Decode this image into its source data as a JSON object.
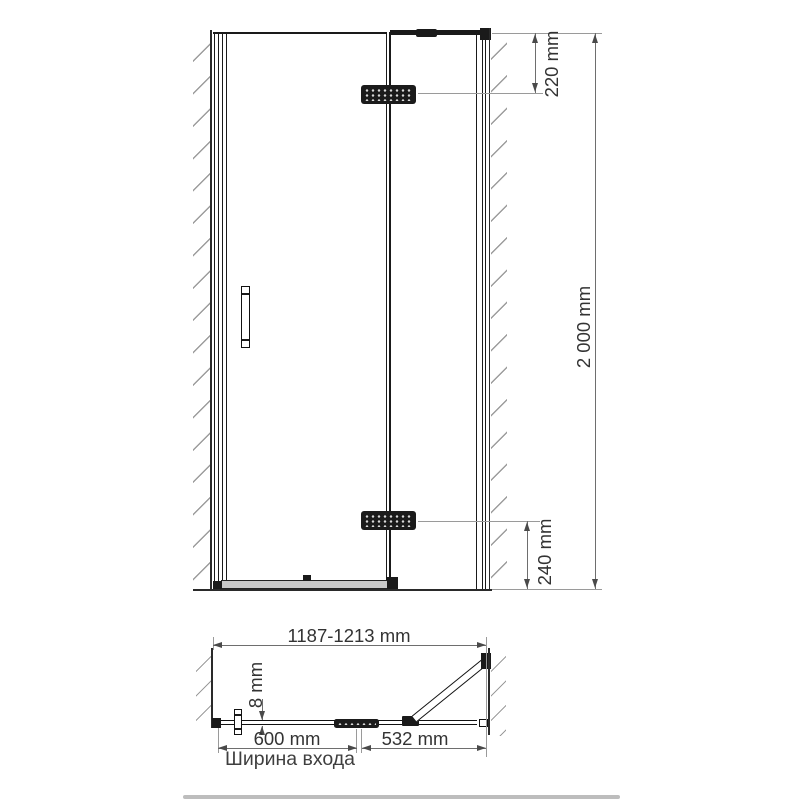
{
  "drawing": {
    "title": "shower-door-technical-drawing",
    "front_view": {
      "dim_top_hinge": "220 mm",
      "dim_height": "2 000 mm",
      "dim_bottom_hinge": "240 mm"
    },
    "plan_view": {
      "dim_total_width": "1187-1213 mm",
      "dim_glass_thickness": "8 mm",
      "dim_door_width": "600 mm",
      "dim_fixed_panel": "532 mm",
      "entrance_width_label": "Ширина входа"
    },
    "colors": {
      "line": "#1a1a1a",
      "dimension_line": "#6e6e6e",
      "extension_line": "#9a9a9a",
      "hatch": "#9c9c9c",
      "text": "#333333",
      "hardware": "#1b1b1b",
      "sill_fill": "#c9c9c9"
    }
  }
}
